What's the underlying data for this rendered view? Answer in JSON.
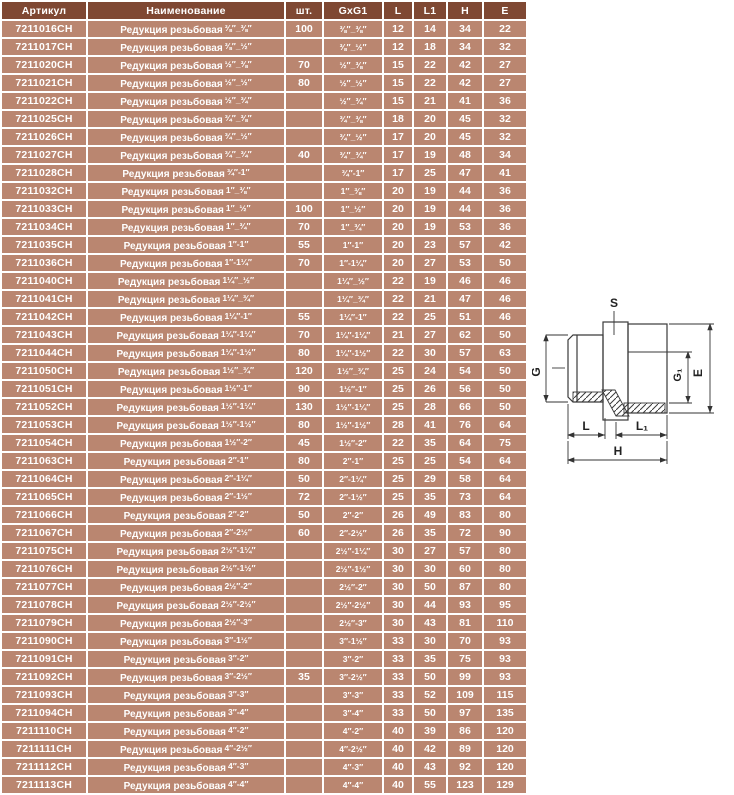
{
  "table": {
    "name_prefix": "Редукция резьбовая",
    "header": {
      "article": "Артикул",
      "name": "Наименование",
      "qty": "шт.",
      "size": "GxG1",
      "l": "L",
      "l1": "L1",
      "h": "H",
      "e": "E"
    },
    "colors": {
      "header_bg": "#7f4833",
      "row_bg": "#ba8670",
      "text": "#ffffff"
    },
    "rows": [
      {
        "article": "7211016CH",
        "qty": "100",
        "size": "⅜″_⅜″",
        "l": "12",
        "l1": "14",
        "h": "34",
        "e": "22"
      },
      {
        "article": "7211017CH",
        "qty": "",
        "size": "⅜″_½″",
        "l": "12",
        "l1": "18",
        "h": "34",
        "e": "32"
      },
      {
        "article": "7211020CH",
        "qty": "70",
        "size": "½″_⅜″",
        "l": "15",
        "l1": "22",
        "h": "42",
        "e": "27"
      },
      {
        "article": "7211021CH",
        "qty": "80",
        "size": "½″_½″",
        "l": "15",
        "l1": "22",
        "h": "42",
        "e": "27"
      },
      {
        "article": "7211022CH",
        "qty": "",
        "size": "½″_¾″",
        "l": "15",
        "l1": "21",
        "h": "41",
        "e": "36"
      },
      {
        "article": "7211025CH",
        "qty": "",
        "size": "¾″_⅜″",
        "l": "18",
        "l1": "20",
        "h": "45",
        "e": "32"
      },
      {
        "article": "7211026CH",
        "qty": "",
        "size": "¾″_½″",
        "l": "17",
        "l1": "20",
        "h": "45",
        "e": "32"
      },
      {
        "article": "7211027CH",
        "qty": "40",
        "size": "¾″_¾″",
        "l": "17",
        "l1": "19",
        "h": "48",
        "e": "34"
      },
      {
        "article": "7211028CH",
        "qty": "",
        "size": "¾″-1″",
        "l": "17",
        "l1": "25",
        "h": "47",
        "e": "41"
      },
      {
        "article": "7211032CH",
        "qty": "",
        "size": "1″_⅜″",
        "l": "20",
        "l1": "19",
        "h": "44",
        "e": "36"
      },
      {
        "article": "7211033CH",
        "qty": "100",
        "size": "1″_½″",
        "l": "20",
        "l1": "19",
        "h": "44",
        "e": "36"
      },
      {
        "article": "7211034CH",
        "qty": "70",
        "size": "1″_¾″",
        "l": "20",
        "l1": "19",
        "h": "53",
        "e": "36"
      },
      {
        "article": "7211035CH",
        "qty": "55",
        "size": "1″-1″",
        "l": "20",
        "l1": "23",
        "h": "57",
        "e": "42"
      },
      {
        "article": "7211036CH",
        "qty": "70",
        "size": "1″-1¼″",
        "l": "20",
        "l1": "27",
        "h": "53",
        "e": "50"
      },
      {
        "article": "7211040CH",
        "qty": "",
        "size": "1¼″_½″",
        "l": "22",
        "l1": "19",
        "h": "46",
        "e": "46"
      },
      {
        "article": "7211041CH",
        "qty": "",
        "size": "1¼″_¾″",
        "l": "22",
        "l1": "21",
        "h": "47",
        "e": "46"
      },
      {
        "article": "7211042CH",
        "qty": "55",
        "size": "1¼″-1″",
        "l": "22",
        "l1": "25",
        "h": "51",
        "e": "46"
      },
      {
        "article": "7211043CH",
        "qty": "70",
        "size": "1¼″-1¼″",
        "l": "21",
        "l1": "27",
        "h": "62",
        "e": "50"
      },
      {
        "article": "7211044CH",
        "qty": "80",
        "size": "1¼″-1½″",
        "l": "22",
        "l1": "30",
        "h": "57",
        "e": "63"
      },
      {
        "article": "7211050CH",
        "qty": "120",
        "size": "1½″_¾″",
        "l": "25",
        "l1": "24",
        "h": "54",
        "e": "50"
      },
      {
        "article": "7211051CH",
        "qty": "90",
        "size": "1½″-1″",
        "l": "25",
        "l1": "26",
        "h": "56",
        "e": "50"
      },
      {
        "article": "7211052CH",
        "qty": "130",
        "size": "1½″-1¼″",
        "l": "25",
        "l1": "28",
        "h": "66",
        "e": "50"
      },
      {
        "article": "7211053CH",
        "qty": "80",
        "size": "1½″-1½″",
        "l": "28",
        "l1": "41",
        "h": "76",
        "e": "64"
      },
      {
        "article": "7211054CH",
        "qty": "45",
        "size": "1½″-2″",
        "l": "22",
        "l1": "35",
        "h": "64",
        "e": "75"
      },
      {
        "article": "7211063CH",
        "qty": "80",
        "size": "2″-1″",
        "l": "25",
        "l1": "25",
        "h": "54",
        "e": "64"
      },
      {
        "article": "7211064CH",
        "qty": "50",
        "size": "2″-1¼″",
        "l": "25",
        "l1": "29",
        "h": "58",
        "e": "64"
      },
      {
        "article": "7211065CH",
        "qty": "72",
        "size": "2″-1½″",
        "l": "25",
        "l1": "35",
        "h": "73",
        "e": "64"
      },
      {
        "article": "7211066CH",
        "qty": "50",
        "size": "2″-2″",
        "l": "26",
        "l1": "49",
        "h": "83",
        "e": "80"
      },
      {
        "article": "7211067CH",
        "qty": "60",
        "size": "2″-2½″",
        "l": "26",
        "l1": "35",
        "h": "72",
        "e": "90"
      },
      {
        "article": "7211075CH",
        "qty": "",
        "size": "2½″-1¼″",
        "l": "30",
        "l1": "27",
        "h": "57",
        "e": "80"
      },
      {
        "article": "7211076CH",
        "qty": "",
        "size": "2½″-1½″",
        "l": "30",
        "l1": "30",
        "h": "60",
        "e": "80"
      },
      {
        "article": "7211077CH",
        "qty": "",
        "size": "2½″-2″",
        "l": "30",
        "l1": "50",
        "h": "87",
        "e": "80"
      },
      {
        "article": "7211078CH",
        "qty": "",
        "size": "2½″-2½″",
        "l": "30",
        "l1": "44",
        "h": "93",
        "e": "95"
      },
      {
        "article": "7211079CH",
        "qty": "",
        "size": "2½″-3″",
        "l": "30",
        "l1": "43",
        "h": "81",
        "e": "110"
      },
      {
        "article": "7211090CH",
        "qty": "",
        "size": "3″-1½″",
        "l": "33",
        "l1": "30",
        "h": "70",
        "e": "93"
      },
      {
        "article": "7211091CH",
        "qty": "",
        "size": "3″-2″",
        "l": "33",
        "l1": "35",
        "h": "75",
        "e": "93"
      },
      {
        "article": "7211092CH",
        "qty": "35",
        "size": "3″-2½″",
        "l": "33",
        "l1": "50",
        "h": "99",
        "e": "93"
      },
      {
        "article": "7211093CH",
        "qty": "",
        "size": "3″-3″",
        "l": "33",
        "l1": "52",
        "h": "109",
        "e": "115"
      },
      {
        "article": "7211094CH",
        "qty": "",
        "size": "3″-4″",
        "l": "33",
        "l1": "50",
        "h": "97",
        "e": "135"
      },
      {
        "article": "7211110CH",
        "qty": "",
        "size": "4″-2″",
        "l": "40",
        "l1": "39",
        "h": "86",
        "e": "120"
      },
      {
        "article": "7211111CH",
        "qty": "",
        "size": "4″-2½″",
        "l": "40",
        "l1": "42",
        "h": "89",
        "e": "120"
      },
      {
        "article": "7211112CH",
        "qty": "",
        "size": "4″-3″",
        "l": "40",
        "l1": "43",
        "h": "92",
        "e": "120"
      },
      {
        "article": "7211113CH",
        "qty": "",
        "size": "4″-4″",
        "l": "40",
        "l1": "55",
        "h": "123",
        "e": "129"
      }
    ]
  },
  "diagram": {
    "labels": {
      "s": "S",
      "g": "G",
      "g1": "G₁",
      "e": "E",
      "l": "L",
      "l1": "L₁",
      "h": "H"
    }
  }
}
